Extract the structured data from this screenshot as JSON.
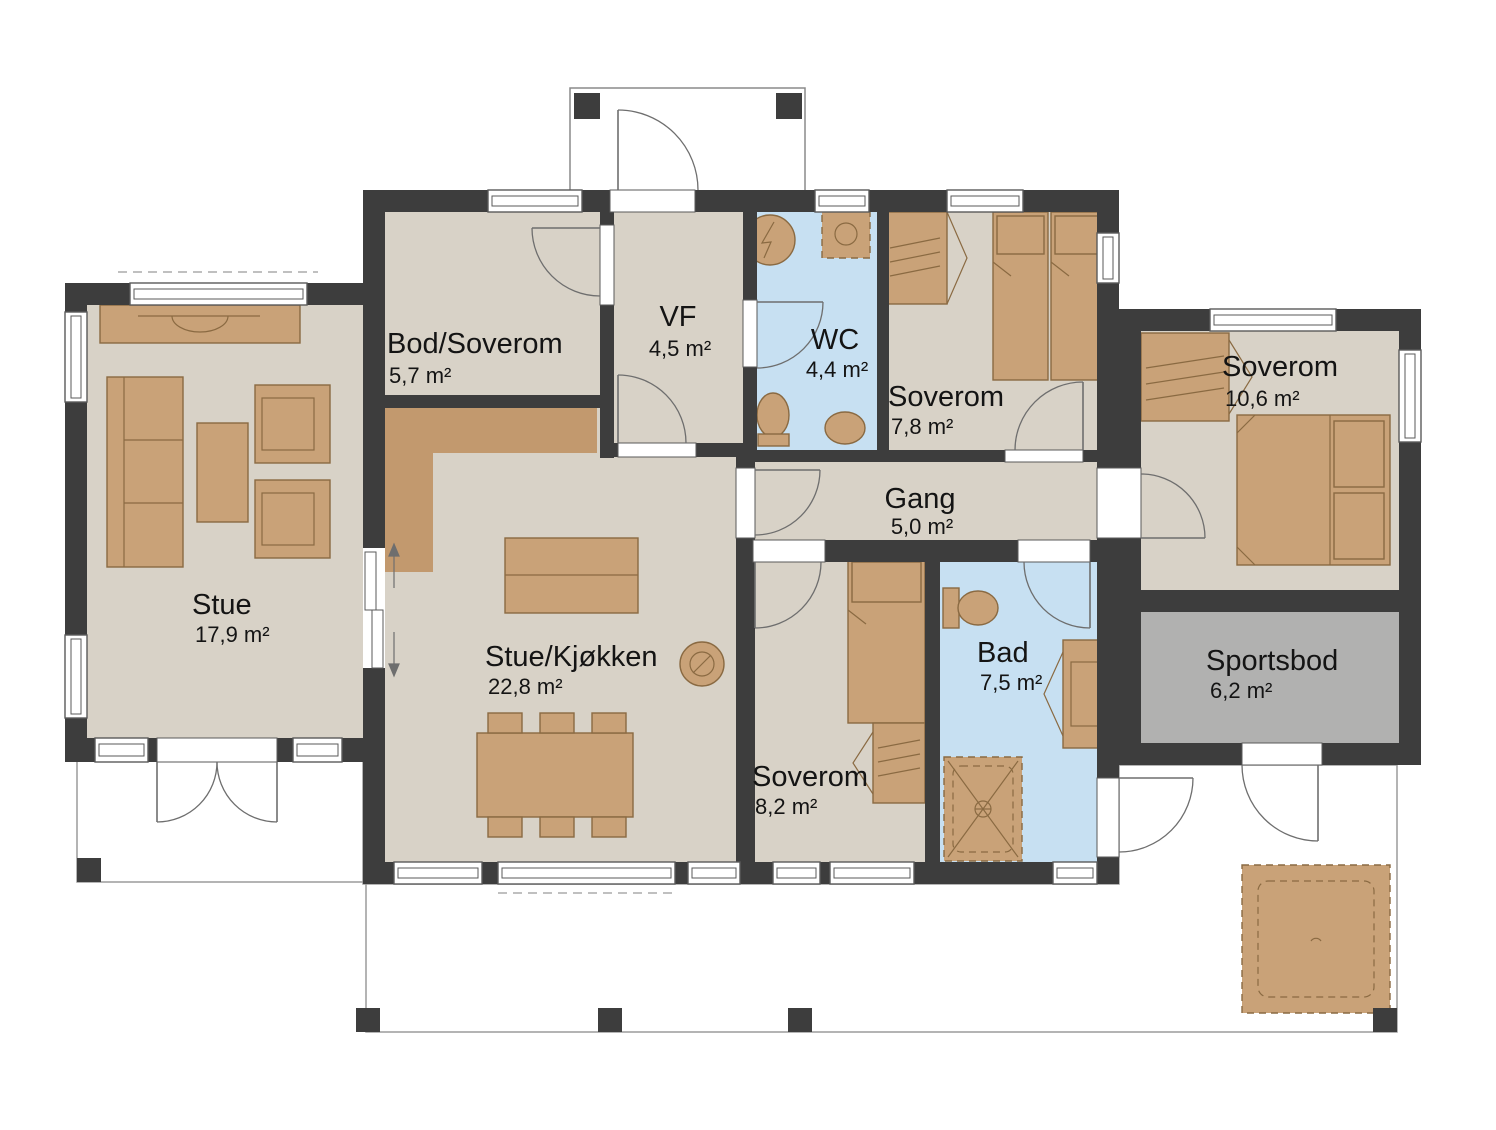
{
  "plan": {
    "rooms": [
      {
        "id": "stue",
        "name": "Stue",
        "area": "17,9 m²"
      },
      {
        "id": "bod_soverom",
        "name": "Bod/Soverom",
        "area": "5,7 m²"
      },
      {
        "id": "vf",
        "name": "VF",
        "area": "4,5 m²"
      },
      {
        "id": "wc",
        "name": "WC",
        "area": "4,4 m²"
      },
      {
        "id": "soverom_78",
        "name": "Soverom",
        "area": "7,8 m²"
      },
      {
        "id": "gang",
        "name": "Gang",
        "area": "5,0 m²"
      },
      {
        "id": "stue_kjokken",
        "name": "Stue/Kjøkken",
        "area": "22,8 m²"
      },
      {
        "id": "soverom_82",
        "name": "Soverom",
        "area": "8,2 m²"
      },
      {
        "id": "bad",
        "name": "Bad",
        "area": "7,5 m²"
      },
      {
        "id": "soverom_106",
        "name": "Soverom",
        "area": "10,6 m²"
      },
      {
        "id": "sportsbod",
        "name": "Sportsbod",
        "area": "6,2 m²"
      }
    ],
    "colors": {
      "wall": "#3d3d3d",
      "floor": "#d8d2c7",
      "wet_room": "#c7e0f2",
      "storage": "#b1b1b0",
      "furniture": "#c9a278",
      "furniture_stroke": "#8a6a42",
      "counter": "#c2996e",
      "deck_stroke": "#9b9b9b"
    }
  }
}
